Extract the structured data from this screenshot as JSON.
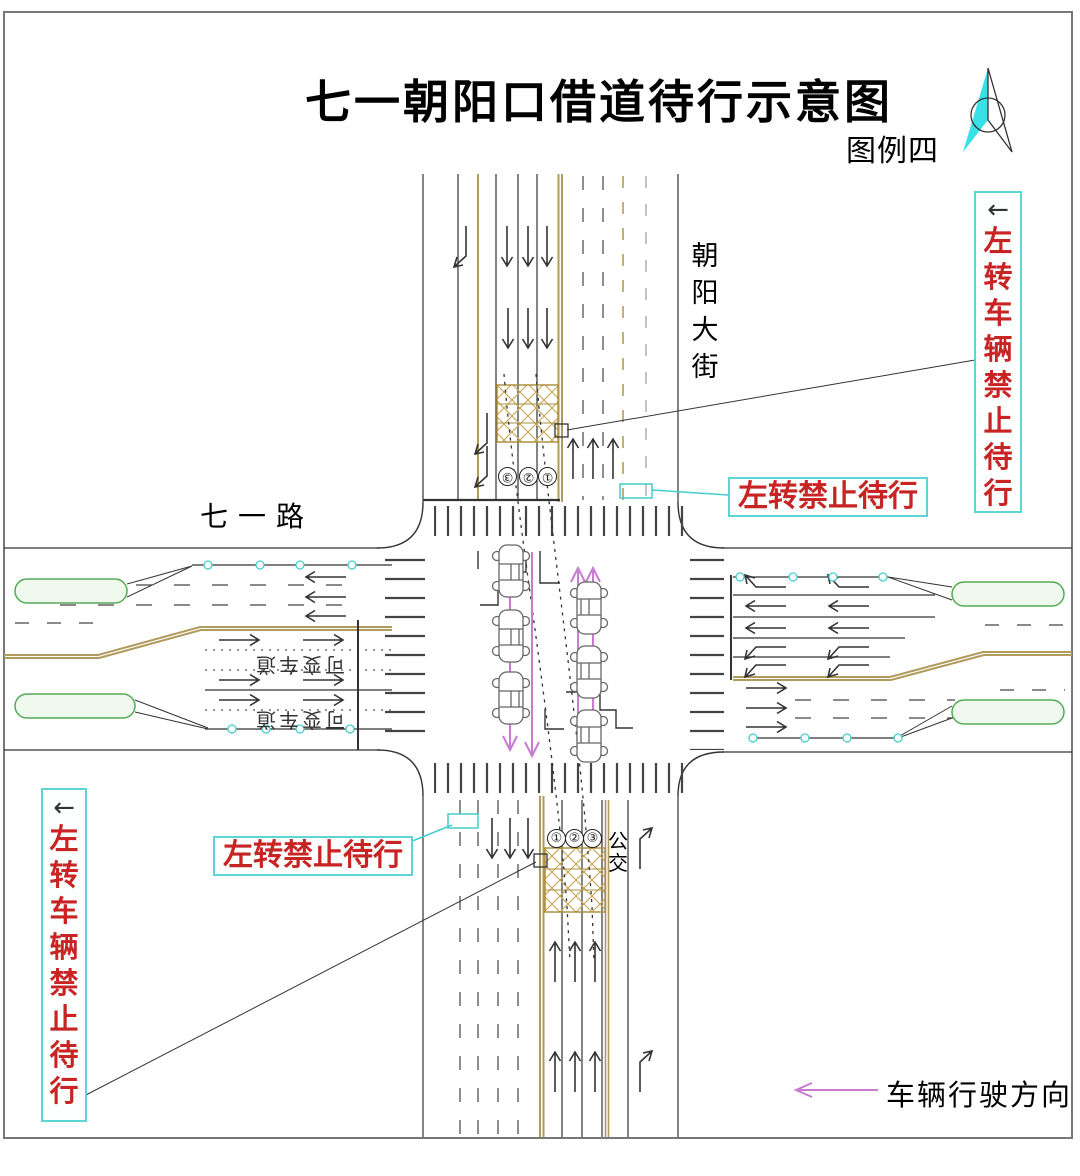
{
  "title": "七一朝阳口借道待行示意图",
  "legend_tag": "图例四",
  "roads": {
    "north_south": "朝阳大街",
    "east_west": "七一路"
  },
  "callouts": {
    "left_arrow": "←",
    "no_wait_long": "左转车辆禁止待行",
    "no_wait_short": "左转禁止待行"
  },
  "lanes": {
    "bus": "公交",
    "variable": "可变车道",
    "south_numbers": [
      "①",
      "②",
      "③"
    ],
    "north_numbers": [
      "③",
      "②",
      "①"
    ]
  },
  "legend": {
    "direction": "车辆行驶方向"
  },
  "colors": {
    "callout_border": "#5ed4d4",
    "warning_text": "#c72423",
    "median_line": "#b09a5c",
    "hatch_area": "#c9ab60",
    "island_green": "#55aa55",
    "vehicle_path_arrow": "#c77cd1",
    "compass_fill": "#3ae0e8",
    "road_line": "#333333"
  }
}
